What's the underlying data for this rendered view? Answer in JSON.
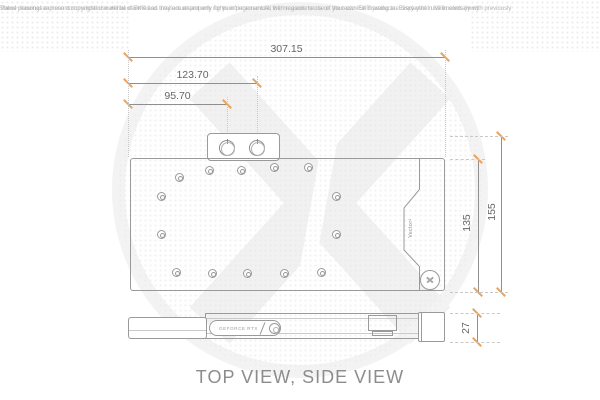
{
  "disclaimer": {
    "line1": "These drawings represent copyrighted material of EK® and they are meant only for your personal use, with regards to use of  your own EK® products. Every other use in contrary with previously",
    "line2": "stated personal and non commercial use will be deemed as intellectual property rights infringement.All the measurements on the technical drawing are displayed in Millimeters (mm)"
  },
  "title": "TOP VIEW, SIDE VIEW",
  "units": "Millimeters (mm)",
  "dimensions": {
    "total_width_mm": "307.15",
    "port2_offset_mm": "123.70",
    "port1_offset_mm": "95.70",
    "total_height_mm": "155",
    "block_height_mm": "135",
    "side_thickness_mm": "27"
  },
  "block_labels": {
    "vector_label": "Vector²",
    "geforce_label": "GEFORCE RTX"
  },
  "colors": {
    "dimension_tick": "#eaa45e",
    "drawing_line": "#9a9a9a",
    "dimension_text": "#666666",
    "title_text": "#8c8c8c",
    "disclaimer_text": "#b4b4b4",
    "watermark": "#f1f1f1"
  }
}
